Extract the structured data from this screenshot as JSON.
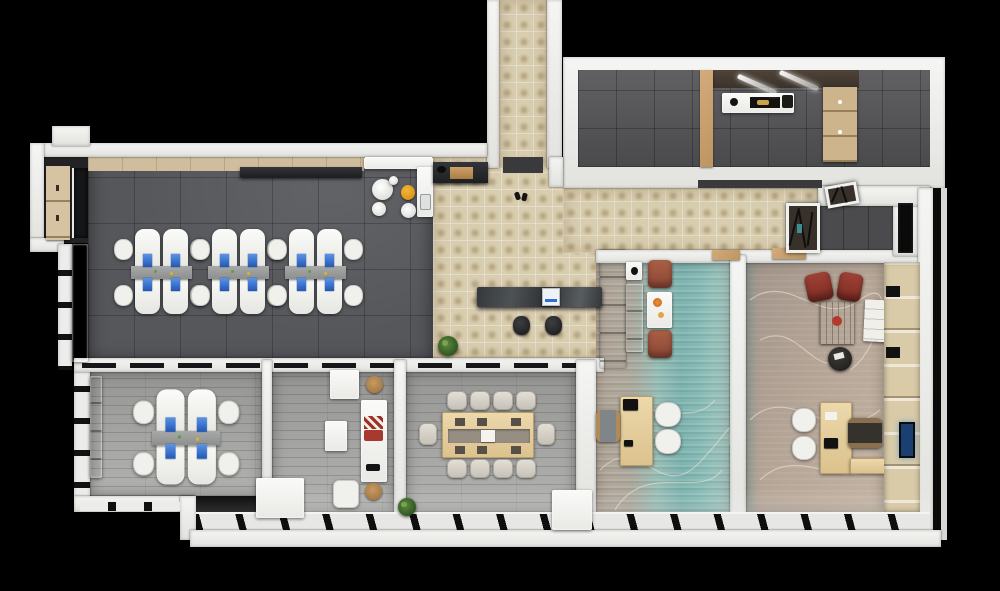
{
  "scene": {
    "type": "3d-floor-plan-render",
    "view": "top-down",
    "background": "#000000",
    "description": "Top-down 3D architectural render of an office floor: open office with desk clusters, kitchenette, entry vestibule, reception with marble counter, lounge, team office, 10-seat meeting room, two executive offices (teal and tan contour carpets), utility room wing and corridor with display niche."
  },
  "palette": {
    "background": "#000000",
    "wall": "#efefec",
    "open_office_carpet": "#55575b",
    "beige_tile": "#d9cdb0",
    "plank_floor": "#a7a7a5",
    "teal_carpet": "#7db3af",
    "tan_carpet": "#b7a798",
    "monitor_blue": "#2e6fd6",
    "rust_armchair": "#9c5340",
    "red_lounge_chair": "#93362c",
    "yellow_stool": "#e8a820",
    "wood": "#c9a878",
    "marble_counter": "#34383b",
    "plant_green": "#3f6b2e",
    "tv_screen_blue": "#1c3f72"
  },
  "rooms": [
    {
      "name": "open-office",
      "floor": "dark gray carpet tiles",
      "furniture": [
        "3 quad desk clusters, white desks with blue monitors",
        "white task chairs",
        "wood floor strip along top wall",
        "dark credenza",
        "closet nook with wood wardrobe and dark cabinet",
        "white sideboard along left window wall"
      ]
    },
    {
      "name": "kitchenette",
      "floor": "dark gray carpet",
      "furniture": [
        "white L counter with sink",
        "round white table",
        "white plate",
        "yellow stool",
        "two white stools"
      ]
    },
    {
      "name": "entry-vestibule",
      "floor": "beige ornate tile",
      "furniture": [
        "dark console with wooden box and black decor",
        "dark door mat",
        "slippers"
      ]
    },
    {
      "name": "reception",
      "floor": "beige ornate tile",
      "furniture": [
        "dark marble reception counter",
        "white monitor",
        "two dark stools",
        "potted plant"
      ]
    },
    {
      "name": "waiting-corner",
      "floor": "teal-tan carpet",
      "furniture": [
        "white sofa",
        "white side table with black lamp",
        "two rust armchairs",
        "white display table with orange artwork"
      ]
    },
    {
      "name": "team-office",
      "floor": "gray plank",
      "furniture": [
        "quad desk cluster with blue monitors",
        "white side cabinets"
      ]
    },
    {
      "name": "lounge",
      "floor": "gray plank",
      "furniture": [
        "white sofa with red and checkered cushions",
        "white armchair",
        "white coffee table",
        "white ottoman",
        "two round wood stools",
        "white utility block",
        "plant"
      ]
    },
    {
      "name": "meeting-room",
      "floor": "gray plank",
      "furniture": [
        "10-seat wood conference table with gray center runner",
        "ten beige chairs",
        "white credenza block"
      ]
    },
    {
      "name": "executive-office-teal",
      "floor": "teal striped contour carpet",
      "furniture": [
        "wood desk with black monitor",
        "gray task chair",
        "two white guest chairs"
      ]
    },
    {
      "name": "executive-office-tan",
      "floor": "tan contour carpet",
      "furniture": [
        "wood desk with return",
        "dark executive chair",
        "two white guest chairs",
        "two dark red lounge chairs",
        "dark wood coffee table with red bowl",
        "white tufted bench",
        "round dark magazine table",
        "wood wall unit with glowing TV"
      ]
    },
    {
      "name": "utility-room-wing",
      "floor": "dark gray tile",
      "furniture": [
        "white counter with dark tray and gold item",
        "two diagonal ceiling light bars",
        "wood partition",
        "wood dresser with drawers"
      ]
    },
    {
      "name": "corridor",
      "floor": "beige ornate tile",
      "furniture": [
        "display niche with branch decor and teal accent",
        "leaning white frame",
        "black storage closet",
        "wood door lintels"
      ]
    },
    {
      "name": "perimeter",
      "floor": "",
      "furniture": [
        "slanted window band along bottom facade",
        "window slit walls on left facade",
        "stepped white exterior walls"
      ]
    }
  ]
}
